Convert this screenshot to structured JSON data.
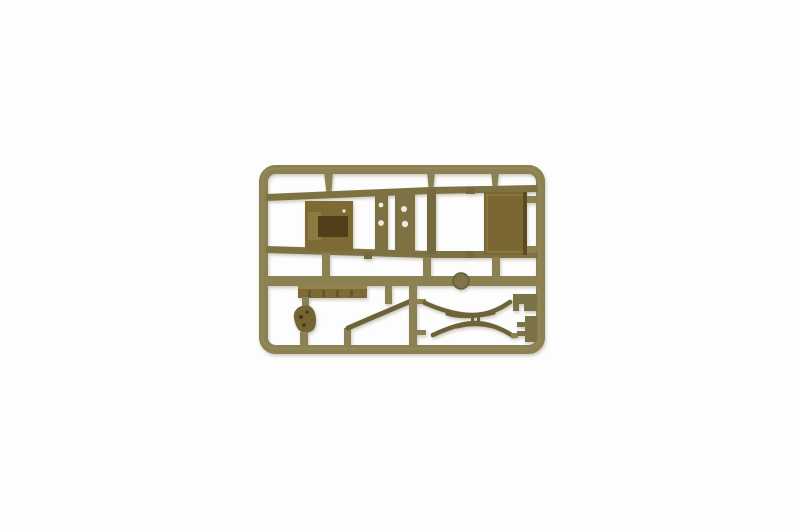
{
  "scene": {
    "type": "product-photograph",
    "subject": "olive drab plastic model kit sprue with vehicle chassis parts",
    "background": "#fdfdfd"
  },
  "colors": {
    "runner": "#8b8153",
    "runner_highlight": "#9d9466",
    "runner_dark": "#6f6540",
    "chassis": "#7e7243",
    "crossmember_dark": "#756a3e",
    "panel_left": "#7e6b33",
    "panel_left_light": "#8c7a42",
    "panel_left_recess": "#503f18",
    "panel_right": "#7a6734",
    "panel_right_frame": "#8d7b45",
    "panel_right_edge": "#5c4b21",
    "bumper": "#7d6b37",
    "bumper_highlight": "#95834b",
    "bumper_tick": "#66542a",
    "part_dark": "#6d6238",
    "blob": "#756434",
    "spot_dark": "#463711",
    "hole": "#eeebdc",
    "disc": "#7e734a",
    "disc_rim": "#665c35",
    "bracket": "#7c7247"
  },
  "parts": [
    {
      "name": "sprue-frame"
    },
    {
      "name": "chassis-frame"
    },
    {
      "name": "skid-plate-panel"
    },
    {
      "name": "cargo-floor-panel"
    },
    {
      "name": "bumper-bar"
    },
    {
      "name": "transfer-case-part"
    },
    {
      "name": "drive-shaft-rod"
    },
    {
      "name": "upper-leaf-spring"
    },
    {
      "name": "lower-leaf-spring"
    },
    {
      "name": "spring-bracket-upper"
    },
    {
      "name": "spring-bracket-lower"
    },
    {
      "name": "round-disc-part"
    },
    {
      "name": "mid-runner"
    },
    {
      "name": "vertical-runner"
    }
  ]
}
